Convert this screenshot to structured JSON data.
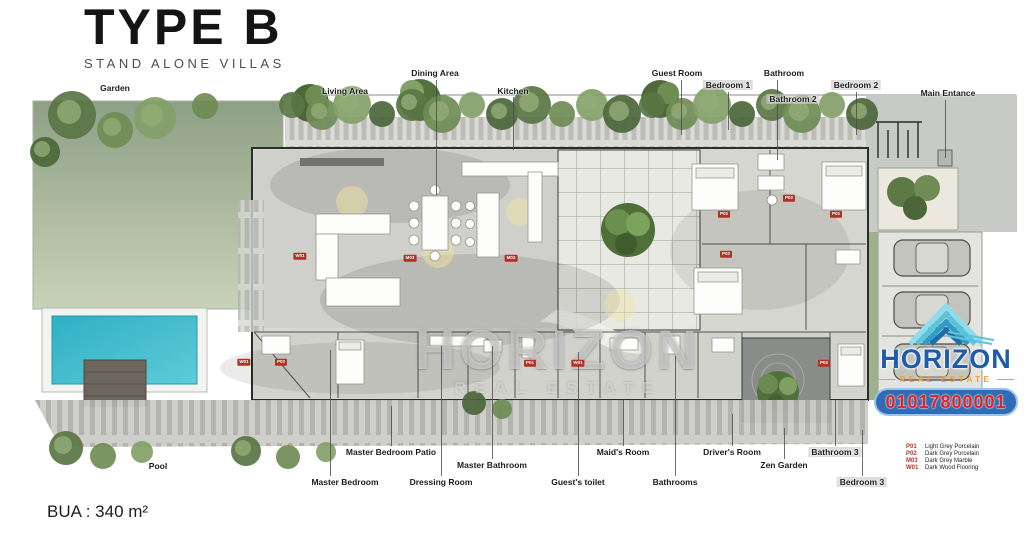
{
  "title": {
    "main": "TYPE B",
    "subtitle": "STAND ALONE VILLAS"
  },
  "area_note": "BUA : 340 m²",
  "watermark": {
    "line1": "HORIZON",
    "line2": "REAL ESTATE"
  },
  "logo": {
    "icon": "layered-pyramid-icon",
    "name": "HORIZON",
    "tagline": "REAL ESTATE",
    "phone": "01017800001",
    "name_color": "#1d5cac",
    "tagline_color": "#f0a230",
    "phone_color": "#e32222",
    "pill_color": "#2f6cb4"
  },
  "legend": [
    {
      "code": "P01",
      "name": "Light Grey Porcelain"
    },
    {
      "code": "P02",
      "name": "Dark Grey Porcelain"
    },
    {
      "code": "M03",
      "name": "Dark Grey Marble"
    },
    {
      "code": "W01",
      "name": "Dark Wood Flooring"
    }
  ],
  "room_labels": [
    {
      "text": "Garden",
      "x": 115,
      "y": 88
    },
    {
      "text": "Living Area",
      "x": 345,
      "y": 91
    },
    {
      "text": "Dining Area",
      "x": 435,
      "y": 73,
      "leader": {
        "x": 436,
        "y1": 80,
        "y2": 195
      }
    },
    {
      "text": "Kitchen",
      "x": 513,
      "y": 91,
      "leader": {
        "x": 513,
        "y1": 97,
        "y2": 150
      }
    },
    {
      "text": "Guest Room",
      "x": 677,
      "y": 73,
      "leader": {
        "x": 681,
        "y1": 80,
        "y2": 135
      }
    },
    {
      "text": "Bedroom 1",
      "x": 728,
      "y": 85,
      "highlight": true,
      "leader": {
        "x": 728,
        "y1": 92,
        "y2": 130
      }
    },
    {
      "text": "Bathroom",
      "x": 784,
      "y": 73,
      "leader": {
        "x": 777,
        "y1": 80,
        "y2": 160
      }
    },
    {
      "text": "Bathroom 2",
      "x": 793,
      "y": 99,
      "highlight": true
    },
    {
      "text": "Bedroom 2",
      "x": 856,
      "y": 85,
      "highlight": true,
      "leader": {
        "x": 856,
        "y1": 92,
        "y2": 135
      }
    },
    {
      "text": "Main Entance",
      "x": 948,
      "y": 93,
      "leader": {
        "x": 945,
        "y1": 100,
        "y2": 158
      }
    },
    {
      "text": "Pool",
      "x": 158,
      "y": 466
    },
    {
      "text": "Master Bedroom Patio",
      "x": 391,
      "y": 452,
      "leader": {
        "x": 391,
        "y1": 406,
        "y2": 446
      }
    },
    {
      "text": "Master Bedroom",
      "x": 345,
      "y": 482,
      "leader": {
        "x": 330,
        "y1": 350,
        "y2": 476
      }
    },
    {
      "text": "Dressing Room",
      "x": 441,
      "y": 482,
      "leader": {
        "x": 441,
        "y1": 346,
        "y2": 476
      }
    },
    {
      "text": "Master Bathroom",
      "x": 492,
      "y": 465,
      "leader": {
        "x": 492,
        "y1": 346,
        "y2": 459
      }
    },
    {
      "text": "Guest's toilet",
      "x": 578,
      "y": 482,
      "leader": {
        "x": 578,
        "y1": 352,
        "y2": 476
      }
    },
    {
      "text": "Maid's Room",
      "x": 623,
      "y": 452,
      "leader": {
        "x": 623,
        "y1": 400,
        "y2": 446
      }
    },
    {
      "text": "Bathrooms",
      "x": 675,
      "y": 482,
      "leader": {
        "x": 675,
        "y1": 356,
        "y2": 476
      }
    },
    {
      "text": "Driver's Room",
      "x": 732,
      "y": 452,
      "leader": {
        "x": 732,
        "y1": 414,
        "y2": 446
      }
    },
    {
      "text": "Zen Garden",
      "x": 784,
      "y": 465,
      "leader": {
        "x": 784,
        "y1": 428,
        "y2": 459
      }
    },
    {
      "text": "Bathroom 3",
      "x": 835,
      "y": 452,
      "highlight": true,
      "leader": {
        "x": 835,
        "y1": 400,
        "y2": 446
      }
    },
    {
      "text": "Bedroom 3",
      "x": 862,
      "y": 482,
      "highlight": true,
      "leader": {
        "x": 862,
        "y1": 430,
        "y2": 476
      }
    }
  ],
  "material_tags": [
    {
      "code": "W01",
      "x": 300,
      "y": 256
    },
    {
      "code": "M03",
      "x": 410,
      "y": 258
    },
    {
      "code": "M03",
      "x": 511,
      "y": 258
    },
    {
      "code": "P02",
      "x": 724,
      "y": 214
    },
    {
      "code": "P02",
      "x": 789,
      "y": 198
    },
    {
      "code": "P02",
      "x": 836,
      "y": 214
    },
    {
      "code": "P02",
      "x": 726,
      "y": 254
    },
    {
      "code": "W01",
      "x": 244,
      "y": 362
    },
    {
      "code": "P02",
      "x": 281,
      "y": 362
    },
    {
      "code": "P01",
      "x": 530,
      "y": 363
    },
    {
      "code": "W01",
      "x": 578,
      "y": 363
    },
    {
      "code": "P02",
      "x": 824,
      "y": 363
    }
  ],
  "colors": {
    "garden_top": "#8da085",
    "garden_bottom": "#c9d2b8",
    "pool": "#3ab5c6",
    "deck": "#6d665d",
    "floor": "#d7d7d3",
    "wall": "#2b2b2b",
    "tag_red": "#b03226",
    "legend_code_red": "#b3362a"
  }
}
